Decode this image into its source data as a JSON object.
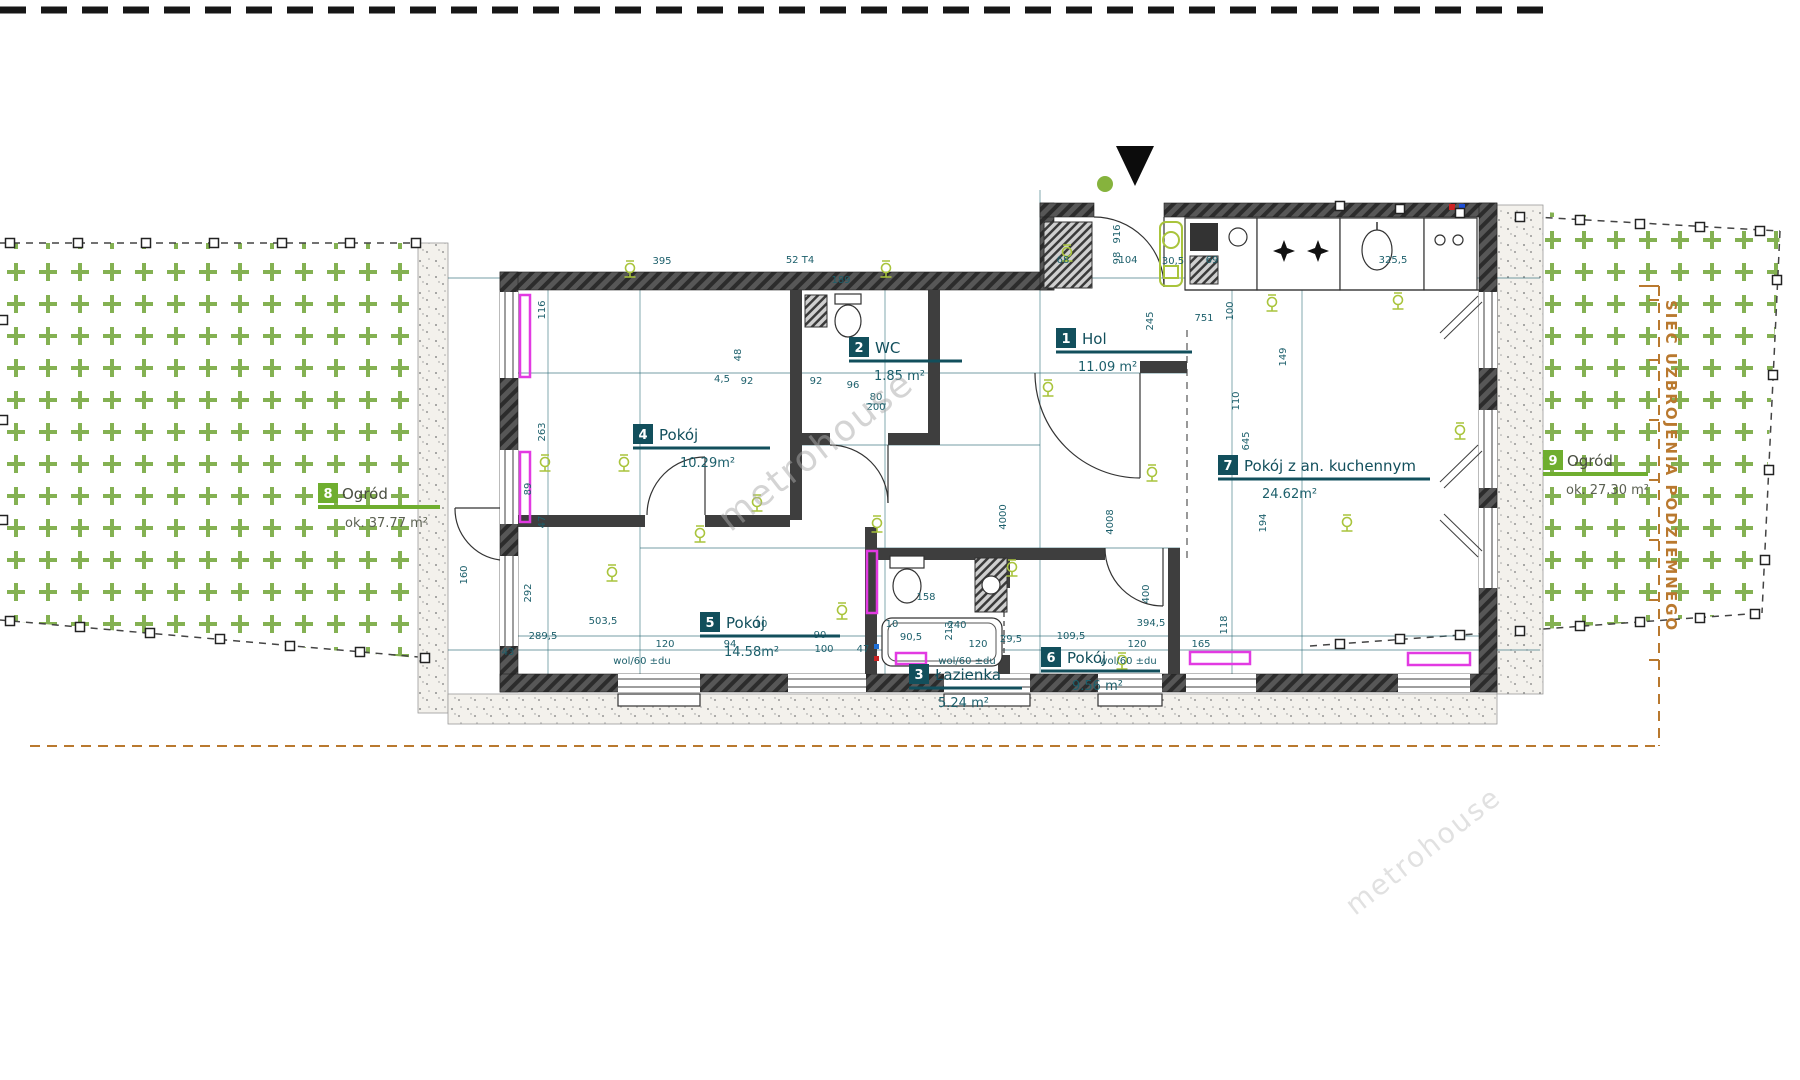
{
  "plan": {
    "watermark": "metrohouse",
    "utility_note": "SIEĆ UZBROJENIA PODZIEMNEGO",
    "icons": {
      "entrance": "entrance-arrow-down-icon",
      "lamp": "ceiling-light-symbol",
      "marker": "boundary-marker"
    },
    "colors": {
      "dim": "#1c5f6b",
      "room_badge": "#124f5c",
      "garden_badge": "#6fae2f",
      "magenta": "#e23ae2",
      "lime": "#a9c43c",
      "orange": "#b9792f",
      "garden_plus": "#84b152"
    },
    "rooms": [
      {
        "num": "1",
        "name": "Hol",
        "area": "11.09 m²"
      },
      {
        "num": "2",
        "name": "WC",
        "area": "1.85 m²"
      },
      {
        "num": "3",
        "name": "Łazienka",
        "area": "5.24 m²"
      },
      {
        "num": "4",
        "name": "Pokój",
        "area": "10.29m²"
      },
      {
        "num": "5",
        "name": "Pokój",
        "area": "14.58m²"
      },
      {
        "num": "6",
        "name": "Pokój",
        "area": "9.56 m²"
      },
      {
        "num": "7",
        "name": "Pokój z an. kuchennym",
        "area": "24.62m²"
      },
      {
        "num": "8",
        "name": "Ogród",
        "area": "ok. 37.77 m²"
      },
      {
        "num": "9",
        "name": "Ogród",
        "area": "ok. 27.30 m²"
      }
    ],
    "dimensions": [
      {
        "t": "395",
        "x": 662,
        "y": 264
      },
      {
        "t": "52 T4",
        "x": 800,
        "y": 263,
        "s": 8
      },
      {
        "t": "189",
        "x": 841,
        "y": 283,
        "s": 9
      },
      {
        "t": "68",
        "x": 1063,
        "y": 263
      },
      {
        "t": "104",
        "x": 1128,
        "y": 263
      },
      {
        "t": "30,5",
        "x": 1173,
        "y": 264,
        "s": 9
      },
      {
        "t": "69",
        "x": 1212,
        "y": 263
      },
      {
        "t": "325,5",
        "x": 1393,
        "y": 263
      },
      {
        "t": "116",
        "x": 545,
        "y": 310,
        "r": 1
      },
      {
        "t": "263",
        "x": 545,
        "y": 432,
        "r": 1
      },
      {
        "t": "47",
        "x": 545,
        "y": 522,
        "r": 1
      },
      {
        "t": "89",
        "x": 531,
        "y": 489,
        "r": 1
      },
      {
        "t": "292",
        "x": 531,
        "y": 593,
        "r": 1
      },
      {
        "t": "160",
        "x": 467,
        "y": 575,
        "r": 1,
        "s": 9
      },
      {
        "t": "916",
        "x": 1120,
        "y": 234,
        "r": 1,
        "s": 9
      },
      {
        "t": "98",
        "x": 1120,
        "y": 258,
        "r": 1,
        "s": 9
      },
      {
        "t": "245",
        "x": 1153,
        "y": 321,
        "r": 1
      },
      {
        "t": "751",
        "x": 1204,
        "y": 321
      },
      {
        "t": "149",
        "x": 1286,
        "y": 357,
        "r": 1
      },
      {
        "t": "100",
        "x": 1233,
        "y": 311,
        "r": 1
      },
      {
        "t": "110",
        "x": 1239,
        "y": 401,
        "r": 1
      },
      {
        "t": "645",
        "x": 1249,
        "y": 441,
        "r": 1
      },
      {
        "t": "194",
        "x": 1266,
        "y": 523,
        "r": 1
      },
      {
        "t": "118",
        "x": 1227,
        "y": 625,
        "r": 1
      },
      {
        "t": "4000",
        "x": 1006,
        "y": 517,
        "r": 1,
        "s": 9
      },
      {
        "t": "4008",
        "x": 1113,
        "y": 522,
        "r": 1,
        "s": 9
      },
      {
        "t": "400",
        "x": 1149,
        "y": 594,
        "r": 1,
        "s": 9
      },
      {
        "t": "158",
        "x": 926,
        "y": 600
      },
      {
        "t": "213",
        "x": 952,
        "y": 631,
        "r": 1
      },
      {
        "t": "92",
        "x": 747,
        "y": 384
      },
      {
        "t": "92",
        "x": 816,
        "y": 384
      },
      {
        "t": "96",
        "x": 853,
        "y": 388
      },
      {
        "t": "4,5",
        "x": 722,
        "y": 382,
        "s": 9
      },
      {
        "t": "48",
        "x": 741,
        "y": 355,
        "r": 1,
        "s": 9
      },
      {
        "t": "80",
        "x": 876,
        "y": 400,
        "s": 8
      },
      {
        "t": "200",
        "x": 876,
        "y": 410,
        "s": 8
      },
      {
        "t": "43",
        "x": 508,
        "y": 655,
        "s": 9
      },
      {
        "t": "289,5",
        "x": 543,
        "y": 639
      },
      {
        "t": "503,5",
        "x": 603,
        "y": 624
      },
      {
        "t": "120",
        "x": 665,
        "y": 647
      },
      {
        "t": "94",
        "x": 730,
        "y": 647
      },
      {
        "t": "10",
        "x": 761,
        "y": 627,
        "s": 8
      },
      {
        "t": "90",
        "x": 820,
        "y": 638,
        "s": 8
      },
      {
        "t": "100",
        "x": 824,
        "y": 652,
        "s": 9
      },
      {
        "t": "47",
        "x": 863,
        "y": 652,
        "s": 9
      },
      {
        "t": "10",
        "x": 892,
        "y": 627,
        "s": 8
      },
      {
        "t": "90,5",
        "x": 911,
        "y": 640,
        "s": 9
      },
      {
        "t": "240",
        "x": 957,
        "y": 628
      },
      {
        "t": "120",
        "x": 978,
        "y": 647
      },
      {
        "t": "29,5",
        "x": 1011,
        "y": 642,
        "s": 9
      },
      {
        "t": "109,5",
        "x": 1071,
        "y": 639
      },
      {
        "t": "120",
        "x": 1137,
        "y": 647
      },
      {
        "t": "394,5",
        "x": 1151,
        "y": 626
      },
      {
        "t": "165",
        "x": 1201,
        "y": 647
      },
      {
        "t": "wol/60 ±du",
        "x": 642,
        "y": 664,
        "s": 8
      },
      {
        "t": "wol/60 ±du",
        "x": 967,
        "y": 664,
        "s": 8
      },
      {
        "t": "wol/60 ±du",
        "x": 1128,
        "y": 664,
        "s": 8
      }
    ]
  }
}
